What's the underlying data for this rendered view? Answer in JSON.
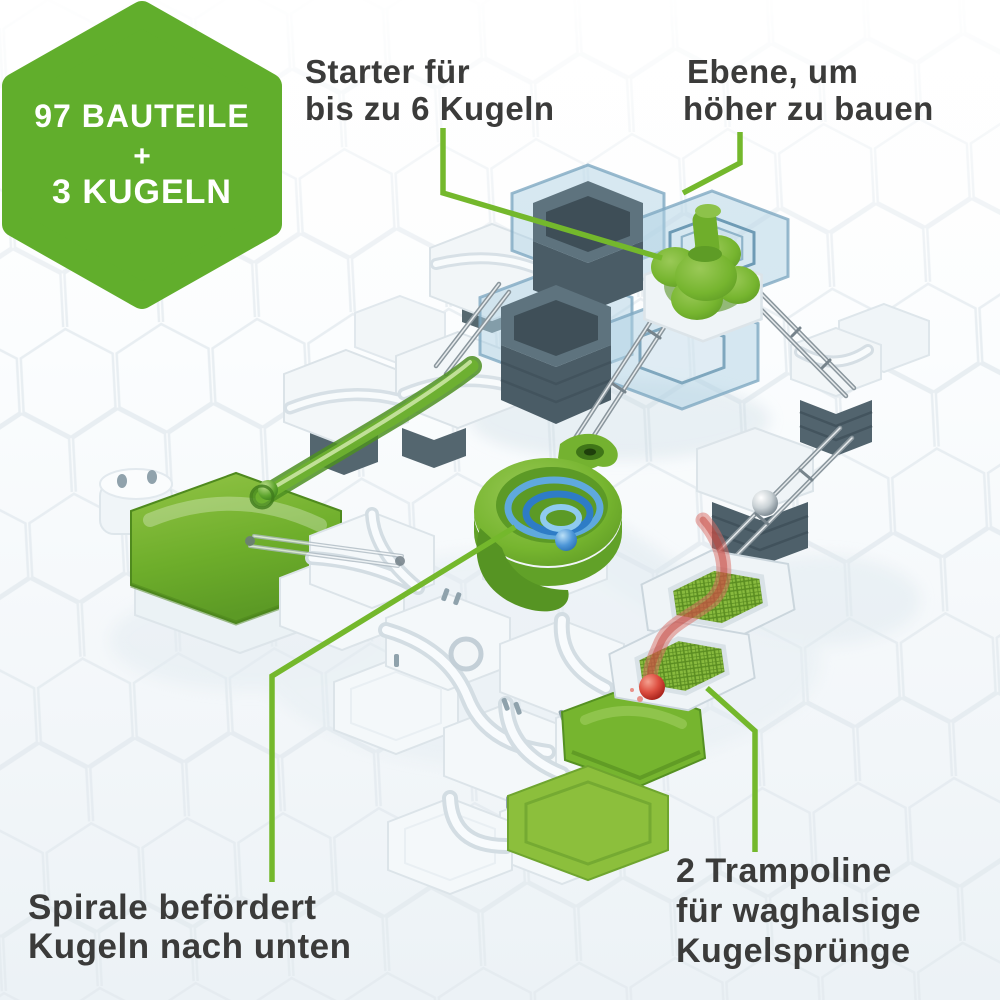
{
  "badge": {
    "count_parts": "97 BAUTEILE",
    "plus": "+",
    "count_balls": "3 KUGELN",
    "bg_color": "#61AE2C",
    "text_color": "#FFFFFF"
  },
  "callouts": {
    "starter": {
      "line1": "Starter für",
      "line2": "bis zu 6 Kugeln"
    },
    "level": {
      "line1": "Ebene, um",
      "line2": "höher zu bauen"
    },
    "spiral": {
      "line1": "Spirale befördert",
      "line2": "Kugeln nach unten"
    },
    "trampoline": {
      "line1": "2 Trampoline",
      "line2": "für waghalsige",
      "line3": "Kugelsprünge"
    }
  },
  "colors": {
    "leader_green": "#74B82C",
    "label_text": "#3B3B3A",
    "plate_blue": "#A9CEE2",
    "slate": "#52646E",
    "piece_green": "#76B52F",
    "ball_blue": "#2F7EC8",
    "ball_red": "#C23B33",
    "ball_green": "#4E9527",
    "ball_silver": "#AEB6BB"
  }
}
